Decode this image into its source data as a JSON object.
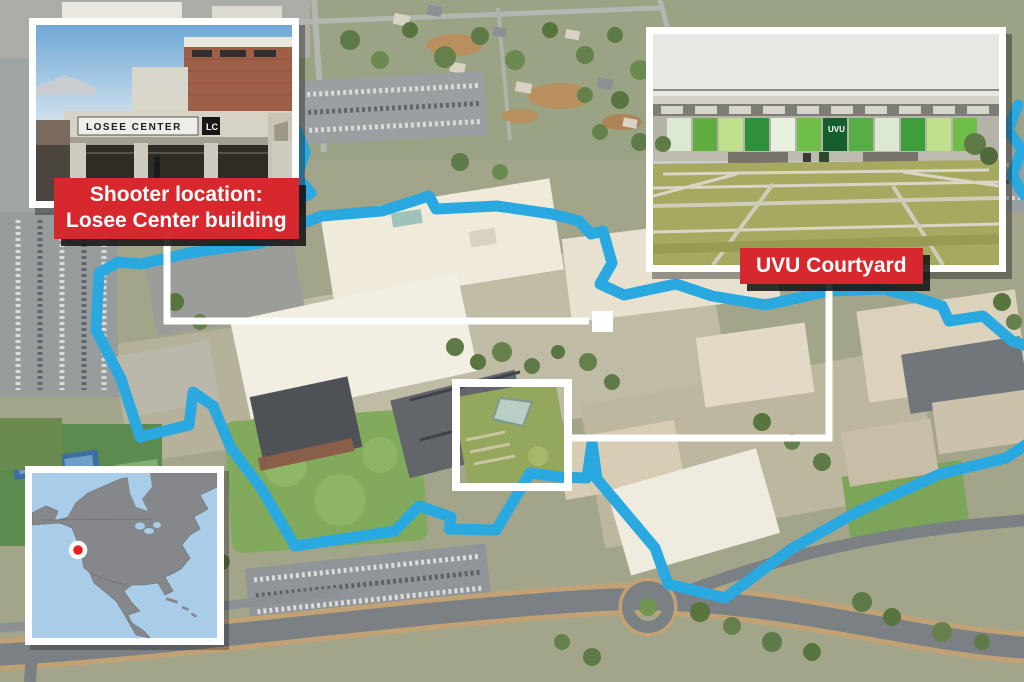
{
  "map": {
    "description_labels": {
      "shooter_line1": "Shooter location:",
      "shooter_line2": "Losee Center building",
      "courtyard": "UVU Courtyard"
    }
  },
  "insets": {
    "losee": {
      "sign_text": "LOSEE CENTER",
      "sign_badge": "LC"
    },
    "courtyard": {
      "panel_text": "UVU"
    }
  },
  "colors": {
    "boundary_blue": "#2aa9e1",
    "callout_white": "#ffffff",
    "label_red": "#d7282e",
    "locator_water": "#a9cce9",
    "locator_land": "#85878a",
    "marker_red": "#e8211d",
    "marker_ring": "#ffffff"
  }
}
